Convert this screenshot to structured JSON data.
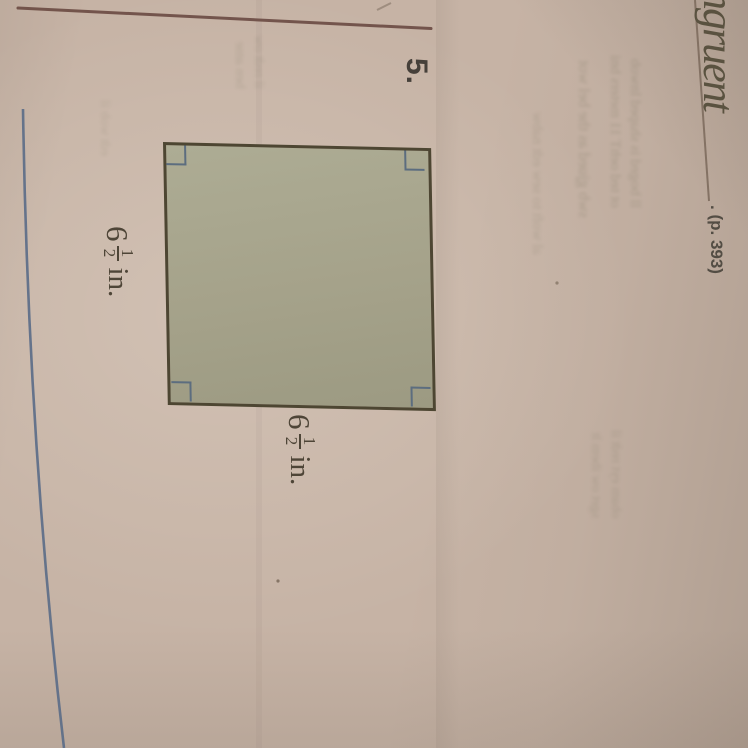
{
  "problem": {
    "number": "5."
  },
  "answer": {
    "handwritten_text": "ngruent",
    "page_reference": ". (p. 393)"
  },
  "figure": {
    "shape": "square",
    "corner_marks": "right-angle marks in all four corners",
    "labels": {
      "left": {
        "whole": "6",
        "numerator": "1",
        "denominator": "2",
        "unit": "in."
      },
      "bottom": {
        "whole": "6",
        "numerator": "1",
        "denominator": "2",
        "unit": "in."
      }
    }
  },
  "colors": {
    "paper": "#c6b3a5",
    "square_fill": "#a7a48c",
    "square_border": "#4d4632",
    "corner_mark": "#5c6d7f",
    "label_text": "#4e4537",
    "top_rule_line": "#6f4f47",
    "blue_edge_line": "#5a6b87",
    "handwriting_ink": "#5a5240"
  },
  "bleed_through": {
    "right_top": [
      "ll boged is shaped lnwob",
      "ot ted oehT 11 meters bni"
    ],
    "right_mid": "swb gjued as the bel wot",
    "right_low": "al woft to sew edt nabw",
    "bottom_right": [
      "obam eyt redt il",
      "sget ow ibem lt"
    ],
    "top_center": [
      "il redt ow",
      "ben ame"
    ],
    "left_mid": "edt wob il"
  }
}
